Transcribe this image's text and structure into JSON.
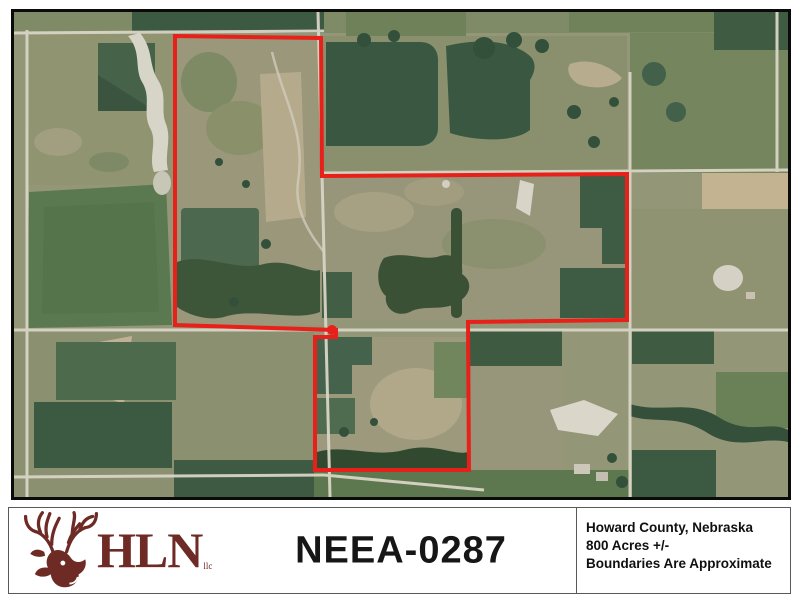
{
  "map": {
    "boundary_color": "#e8201a",
    "road_color": "#d9d5c6",
    "frame_color": "#0b0b0b"
  },
  "footer": {
    "logo": {
      "name": "HLN",
      "suffix": "llc",
      "color": "#6e2a25",
      "icon": "deer-buck"
    },
    "listing_id": "NEEA-0287",
    "details": [
      "Howard County, Nebraska",
      "800 Acres +/-",
      "Boundaries Are Approximate"
    ]
  }
}
